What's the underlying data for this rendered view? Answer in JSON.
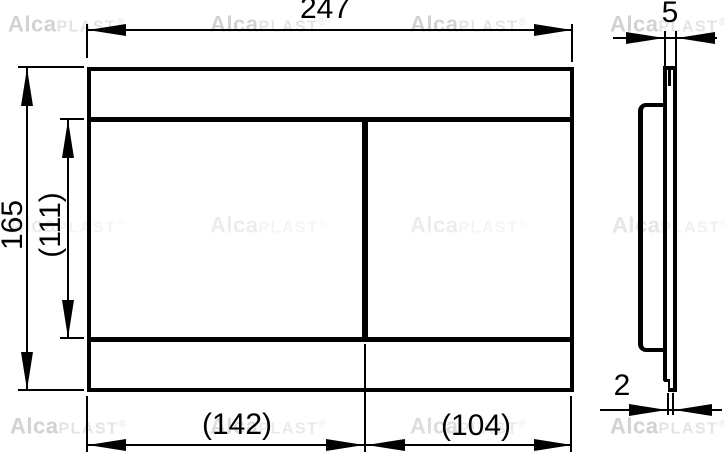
{
  "watermark": {
    "bold": "Alca",
    "light": "PLAST",
    "registered": "®"
  },
  "views": {
    "front": {
      "width_label": "247",
      "height_label": "165",
      "inner_height_label": "(111)",
      "left_section_width_label": "(142)",
      "right_section_width_label": "(104)"
    },
    "side": {
      "thickness_label": "5",
      "bottom_edge_thickness_label": "2"
    }
  },
  "colors": {
    "line": "#000000",
    "watermark_bold": "#d2d2d2",
    "watermark_light": "#e4e4e4",
    "background": "#ffffff"
  }
}
